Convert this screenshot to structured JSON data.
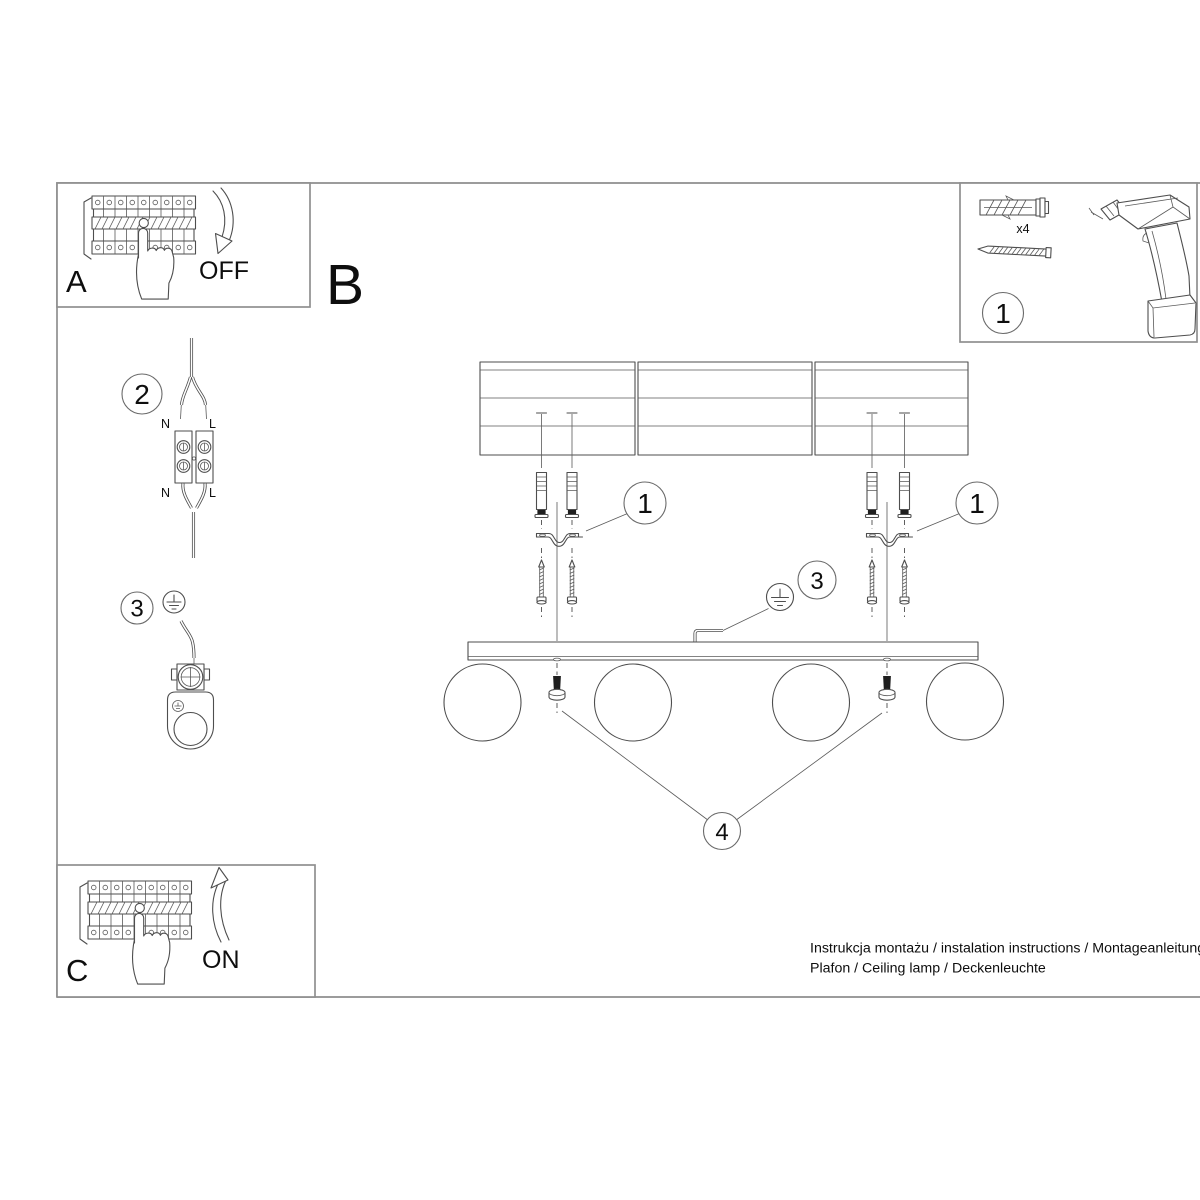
{
  "sheet": {
    "footer_line1": "Instrukcja montażu / instalation instructions / Montageanleitung",
    "footer_line2": "Plafon / Ceiling lamp / Deckenleuchte"
  },
  "sections": {
    "step_a_label": "A",
    "step_b_label": "B",
    "step_c_label": "C"
  },
  "breaker": {
    "off_label": "OFF",
    "on_label": "ON",
    "equals_mark": "="
  },
  "callouts": {
    "mounting_kit": "1",
    "wire_terminal": "2",
    "ground_wire": "3",
    "fixing_screw": "4"
  },
  "wiring": {
    "neutral": "N",
    "live": "L"
  },
  "parts_box": {
    "dowel_quantity": "x4"
  },
  "colors": {
    "background": "#ffffff",
    "line": "#4e4e4e",
    "frame": "#8f8f8f",
    "text": "#0e0e0e",
    "screw_fill": "#1f1f1f"
  }
}
